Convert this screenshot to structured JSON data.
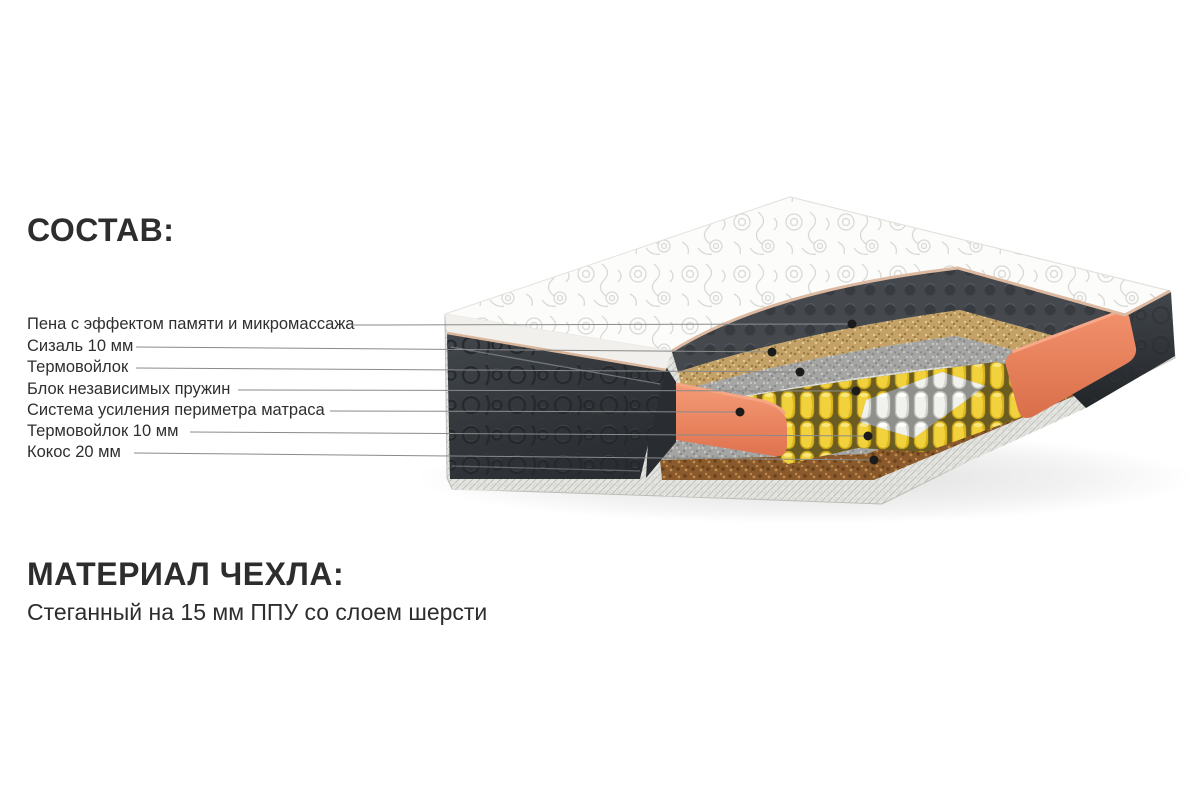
{
  "composition": {
    "heading": "СОСТАВ:",
    "labels": [
      {
        "text": "Пена с эффектом памяти и микромассажа"
      },
      {
        "text": "Сизаль 10 мм"
      },
      {
        "text": "Термовойлок"
      },
      {
        "text": "Блок независимых пружин"
      },
      {
        "text": "Система усиления периметра матраса"
      },
      {
        "text": "Термовойлок 10 мм"
      },
      {
        "text": "Кокос 20 мм"
      }
    ]
  },
  "cover_material": {
    "heading": "МАТЕРИАЛ ЧЕХЛА:",
    "description": "Стеганный на 15 мм ППУ со слоем шерсти"
  },
  "diagram": {
    "type": "mattress-cutaway-illustration",
    "layers": [
      "quilted-cover",
      "memory-foam",
      "sisal",
      "thermofelt",
      "independent-spring-block",
      "perimeter-reinforcement",
      "thermofelt-bottom",
      "coconut-coir"
    ],
    "colors": {
      "coral_perimeter": "#e8805b",
      "yellow_springs": "#f2d23c",
      "white_springs": "#f1f1ed",
      "felt_gray": "#a5a5a3",
      "sisal_tan": "#c4a267",
      "coconut_brown": "#8b5a2c",
      "side_charcoal": "#34383c",
      "cover_white": "#fcfcfb",
      "piping_tan": "#dcb9a0",
      "leader_line": "#8a8a8a",
      "callout_dot": "#1b1b1b"
    }
  }
}
